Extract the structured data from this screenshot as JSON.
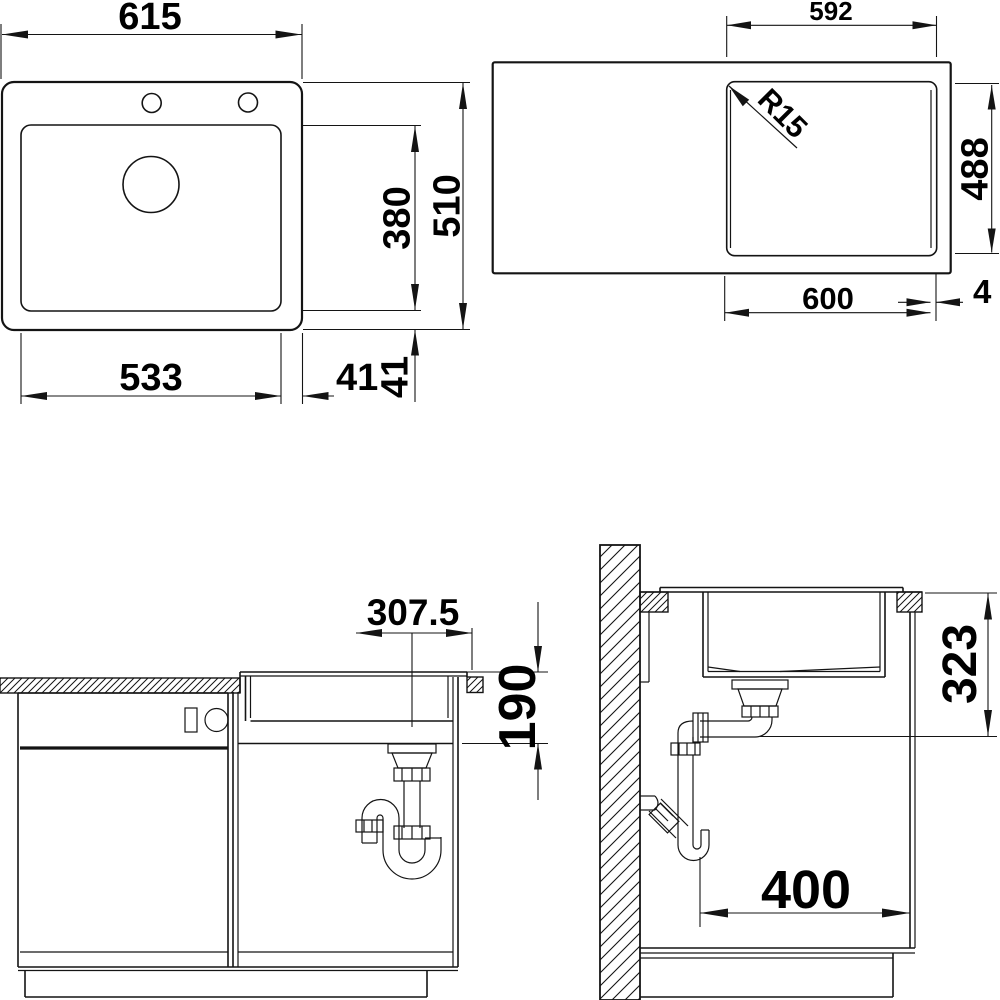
{
  "drawing": {
    "type": "sink installation dimension drawing",
    "units": "mm",
    "line_color": "#141414",
    "background": "#ffffff"
  },
  "views": {
    "sink_top": {
      "overall_width": "615",
      "bowl_width": "533",
      "edge_offset_h": "41",
      "edge_offset_v": "41",
      "bowl_depth": "380",
      "overall_depth": "510"
    },
    "cutout_top": {
      "cutout_width": "592",
      "corner_radius": "R15",
      "cutout_depth": "488",
      "bowl_width": "600",
      "reveal": "4"
    },
    "front_section": {
      "center_to_edge": "307.5",
      "bowl_height": "190"
    },
    "side_section": {
      "under_counter_height": "323",
      "drain_setback": "400"
    }
  }
}
